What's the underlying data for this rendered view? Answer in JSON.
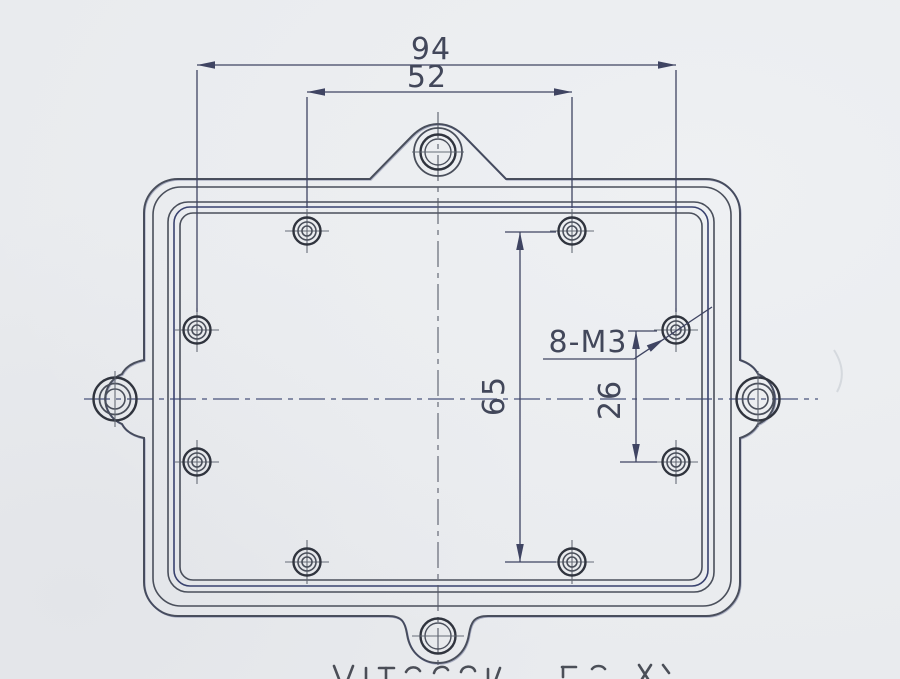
{
  "drawing": {
    "kind": "technical-drawing-cover-plate",
    "dimensions": {
      "h_outer": "94",
      "h_top": "52",
      "v_left": "65",
      "v_right": "26"
    },
    "callouts": {
      "thread": "8-M3"
    },
    "colors": {
      "paper": "#e9ebee",
      "ink": "#4a4f5b",
      "ink-dark": "#30343e",
      "navy": "#39426f",
      "dim": "#3f4462",
      "text": "#42475a"
    }
  }
}
